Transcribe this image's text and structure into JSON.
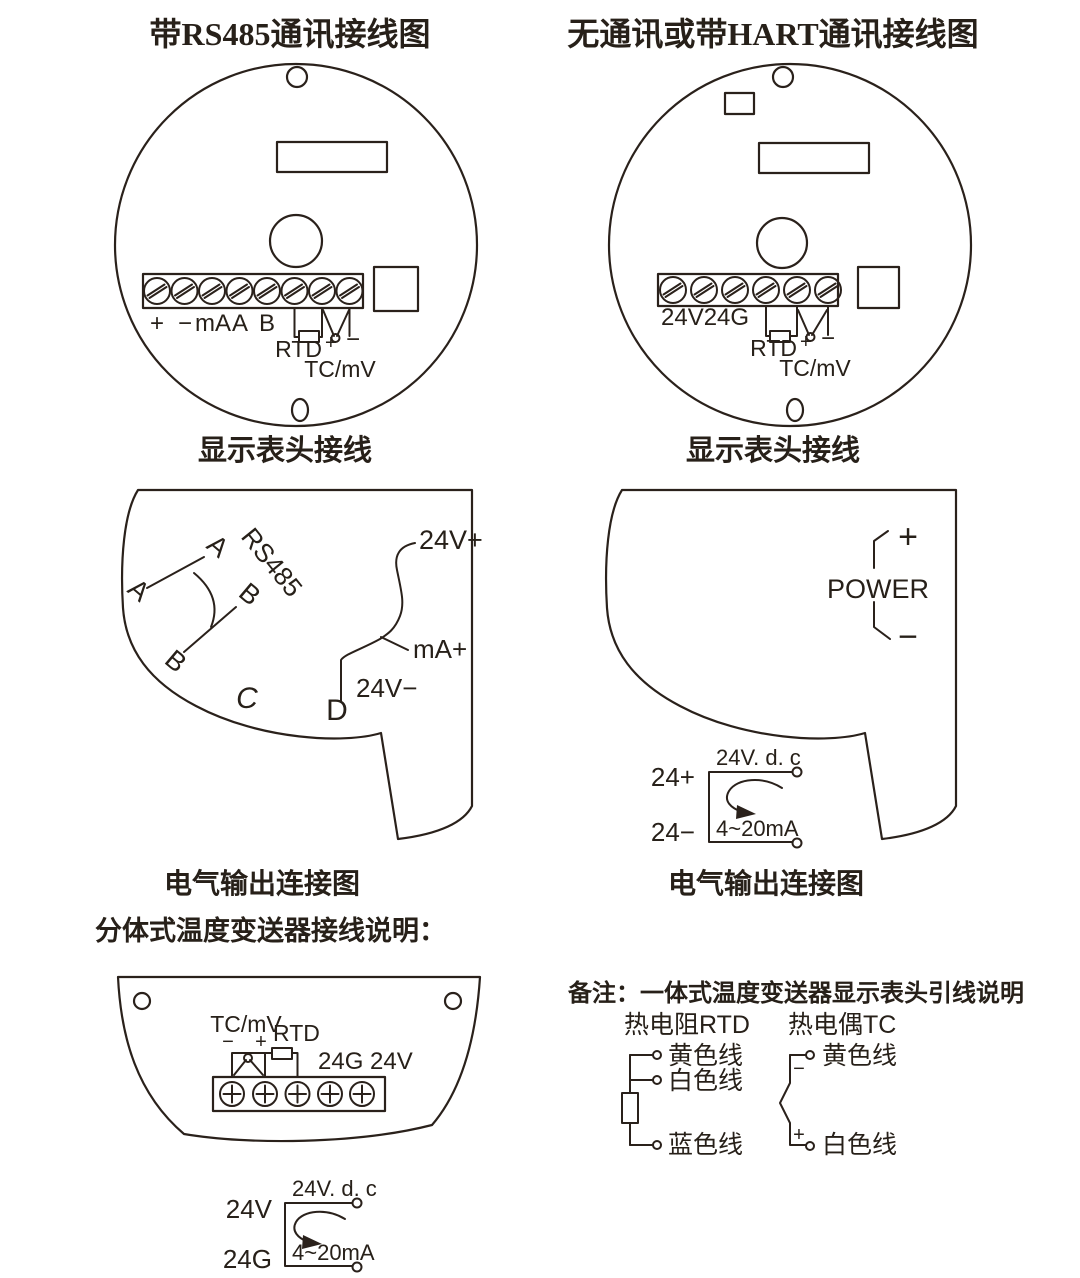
{
  "titles": {
    "left": "带RS485通讯接线图",
    "right": "无通讯或带HART通讯接线图"
  },
  "captions": {
    "display_head_left": "显示表头接线",
    "display_head_right": "显示表头接线",
    "output_left": "电气输出连接图",
    "output_right": "电气输出连接图",
    "split_note": "分体式温度变送器接线说明："
  },
  "terminal_left": {
    "row": [
      "+",
      "−",
      "mA",
      "A",
      "B"
    ],
    "rtd": "RTD",
    "rtd_plus": "+",
    "rtd_minus": "−",
    "tc": "TC/mV"
  },
  "terminal_right": {
    "power": "24V24G",
    "rtd": "RTD",
    "rtd_plus": "+",
    "rtd_minus": "−",
    "tc": "TC/mV"
  },
  "output_head_left": {
    "a_top": "A",
    "a_bottom": "A",
    "b_top": "B",
    "b_bottom": "B",
    "bus": "RS485",
    "c": "C",
    "d": "D",
    "v_plus": "24V+",
    "ma_plus": "mA+",
    "v_minus": "24V−"
  },
  "output_head_right": {
    "plus": "+",
    "power": "POWER",
    "minus": "−"
  },
  "dc_right": {
    "pos": "24+",
    "neg": "24−",
    "supply": "24V. d. c",
    "current": "4~20mA"
  },
  "dc_left": {
    "pos": "24V",
    "neg": "24G",
    "supply": "24V. d. c",
    "current": "4~20mA"
  },
  "split_head": {
    "tc": "TC/mV",
    "minus": "−",
    "plus": "+",
    "rtd": "RTD",
    "power": "24G 24V"
  },
  "note": {
    "title": "备注：一体式温度变送器显示表头引线说明",
    "rtd_title": "热电阻RTD",
    "tc_title": "热电偶TC",
    "rtd_wire1": "黄色线",
    "rtd_wire2": "白色线",
    "rtd_wire3": "蓝色线",
    "tc_minus": "−",
    "tc_plus": "+",
    "tc_wire1": "黄色线",
    "tc_wire2": "白色线"
  },
  "colors": {
    "ink": "#2a211b",
    "background": "#ffffff"
  }
}
